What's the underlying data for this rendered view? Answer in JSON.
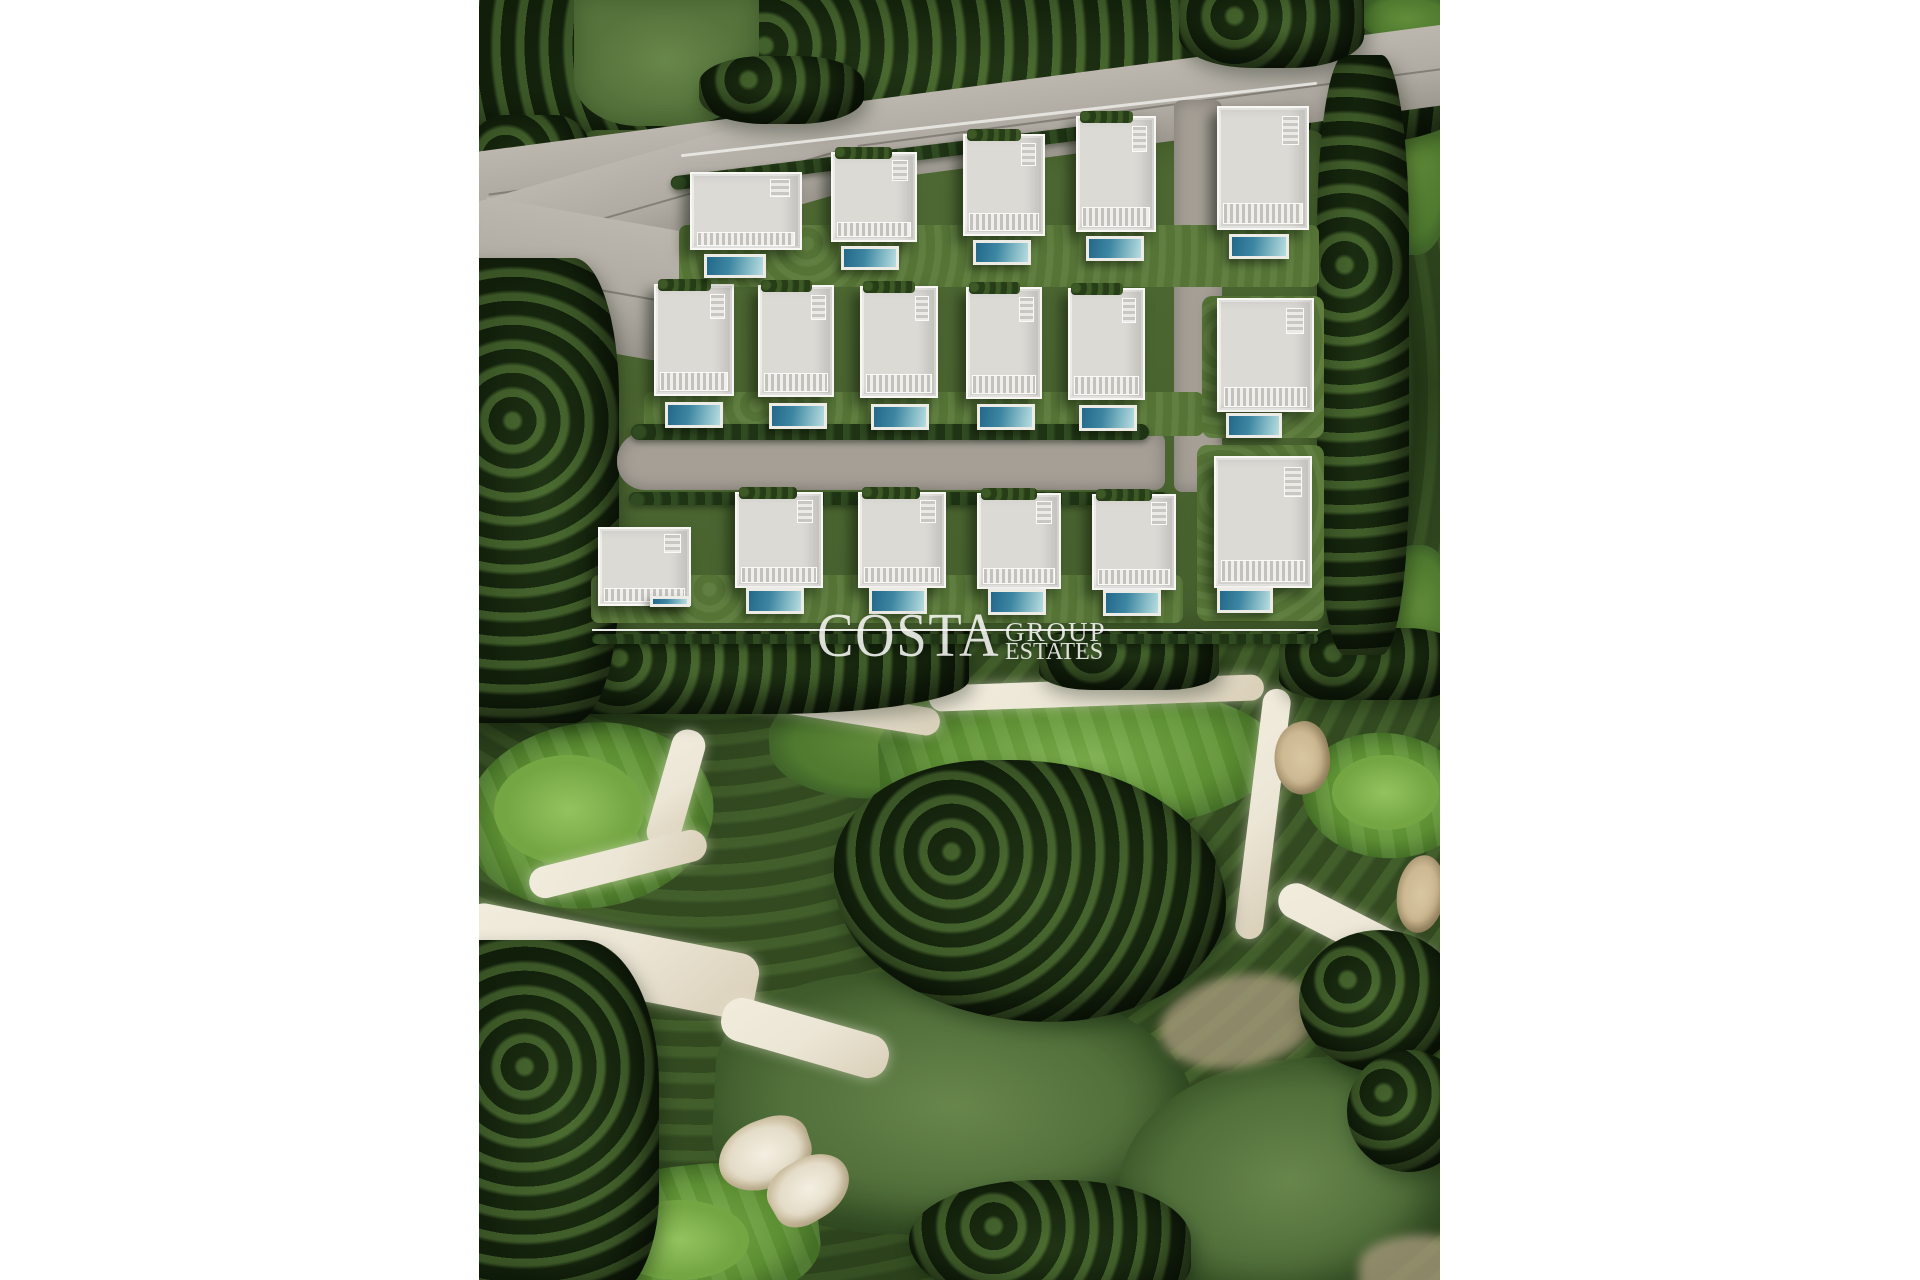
{
  "palette": {
    "canvas_bg": "#ffffff",
    "tree_dark": "#243b1a",
    "grass": "#5e7d40",
    "fairway_bright": "#6ba23f",
    "fairway_muted": "#55743d",
    "road": "#afaaa1",
    "road_inner": "#a59f96",
    "sand": "#ece6d6",
    "bunker": "#cdb992",
    "villa_roof": "#dcdad5",
    "villa_white": "#f8f7f4",
    "pool_deep": "#23688a",
    "pool_light": "#b8dde0",
    "lawn": "#5a7a39",
    "watermark": "rgba(253,253,250,0.85)"
  },
  "scene": {
    "x": 479,
    "y": 0,
    "width": 961,
    "height": 1280
  },
  "watermark": {
    "brand": "COSTA",
    "sub_top": "GROUP",
    "sub_bottom": "ESTATES",
    "line": {
      "x": 113,
      "y": 629,
      "width": 726,
      "height": 2
    },
    "brand_pos": {
      "x": 338,
      "y": 605,
      "size": 62,
      "ls": 2
    },
    "sub_top_pos": {
      "x": 526,
      "y": 619,
      "size": 27,
      "ls": 2
    },
    "sub_bottom_pos": {
      "x": 526,
      "y": 640,
      "size": 24,
      "ls": 0
    }
  },
  "elements": [
    {
      "name": "tree-band-top",
      "cls": "trees",
      "x": -10,
      "y": -12,
      "w": 985,
      "h": 165,
      "z": 6,
      "br": "0 0 22% 14%"
    },
    {
      "name": "grass-patch-top-left",
      "cls": "grass-light",
      "x": 95,
      "y": -6,
      "w": 185,
      "h": 132,
      "z": 7,
      "br": "0 0 45% 35%"
    },
    {
      "name": "grass-patch-top-right",
      "cls": "green-mid",
      "x": 878,
      "y": -6,
      "w": 100,
      "h": 50,
      "z": 7,
      "br": "0 0 0 60%"
    },
    {
      "name": "road-main",
      "cls": "road",
      "x": -15,
      "y": 88,
      "w": 1000,
      "h": 80,
      "rot": -7.5,
      "z": 8
    },
    {
      "name": "road-main-lower",
      "cls": "road",
      "x": -15,
      "y": 150,
      "w": 400,
      "h": 92,
      "rot": -16,
      "z": 8,
      "br": "0 0 40px 0"
    },
    {
      "name": "road-entry-apron",
      "cls": "road",
      "x": -5,
      "y": 215,
      "w": 218,
      "h": 132,
      "rot": 10,
      "z": 8,
      "br": "0 0 30px 70px"
    },
    {
      "name": "tree-overhang-left",
      "cls": "trees",
      "x": 220,
      "y": 56,
      "w": 165,
      "h": 68,
      "z": 9,
      "br": "40%"
    },
    {
      "name": "tree-overhang-right",
      "cls": "trees",
      "x": 700,
      "y": -12,
      "w": 185,
      "h": 80,
      "z": 9,
      "br": "0 0 40% 40%"
    },
    {
      "name": "development-ground",
      "cls": "dev",
      "x": 100,
      "y": 130,
      "w": 748,
      "h": 500,
      "z": 7,
      "br": "18px"
    },
    {
      "name": "retaining-wall-row1",
      "cls": "wall",
      "x": 200,
      "y": 118,
      "w": 640,
      "h": 3,
      "rot": -6.5,
      "z": 10
    },
    {
      "name": "hedge-row-along-road",
      "cls": "hedge",
      "x": 190,
      "y": 148,
      "w": 470,
      "h": 14,
      "rot": -7,
      "z": 10
    },
    {
      "name": "street-inner",
      "cls": "road2",
      "x": 138,
      "y": 432,
      "w": 548,
      "h": 58,
      "z": 9,
      "br": "28px 10px 10px 28px"
    },
    {
      "name": "lane-right-vertical",
      "cls": "road2",
      "x": 695,
      "y": 100,
      "w": 48,
      "h": 392,
      "z": 9,
      "br": "8px"
    },
    {
      "name": "hedge-row-above-street",
      "cls": "hedge",
      "x": 152,
      "y": 424,
      "w": 518,
      "h": 16,
      "z": 10
    },
    {
      "name": "hedge-row-below-street",
      "cls": "hedge",
      "x": 150,
      "y": 492,
      "w": 540,
      "h": 13,
      "z": 10
    },
    {
      "name": "lawn-row1",
      "cls": "lawn",
      "x": 200,
      "y": 225,
      "w": 640,
      "h": 62,
      "z": 9,
      "br": "8px"
    },
    {
      "name": "lawn-row2",
      "cls": "lawn",
      "x": 165,
      "y": 392,
      "w": 560,
      "h": 44,
      "z": 9,
      "br": "8px"
    },
    {
      "name": "lawn-villa-r2-6",
      "cls": "lawn",
      "x": 723,
      "y": 296,
      "w": 122,
      "h": 142,
      "z": 9,
      "br": "10px"
    },
    {
      "name": "lawn-row3",
      "cls": "lawn",
      "x": 112,
      "y": 575,
      "w": 592,
      "h": 48,
      "z": 9,
      "br": "8px"
    },
    {
      "name": "lawn-villa-r3-6",
      "cls": "lawn",
      "x": 718,
      "y": 445,
      "w": 127,
      "h": 176,
      "z": 9,
      "br": "10px"
    },
    {
      "name": "hedge-under-watermark",
      "cls": "hedge",
      "x": 113,
      "y": 634,
      "w": 726,
      "h": 10,
      "z": 19
    },
    {
      "name": "fairway-strip-right-top",
      "cls": "green-mid",
      "x": 893,
      "y": 55,
      "w": 82,
      "h": 200,
      "z": 1,
      "br": "45%"
    },
    {
      "name": "fairway-strip-right-mid",
      "cls": "green-mid",
      "x": 903,
      "y": 545,
      "w": 72,
      "h": 120,
      "z": 1,
      "br": "45%"
    },
    {
      "name": "golf-green-left",
      "cls": "green-bright",
      "x": -15,
      "y": 723,
      "w": 250,
      "h": 185,
      "z": 2,
      "rot": -8,
      "br": "50%"
    },
    {
      "name": "golf-green-left-apron",
      "cls": "green-lighter",
      "x": 15,
      "y": 755,
      "w": 150,
      "h": 110,
      "z": 3,
      "br": "50%"
    },
    {
      "name": "fairway-center-upper",
      "cls": "green-mid",
      "x": 290,
      "y": 678,
      "w": 250,
      "h": 120,
      "z": 2,
      "rot": -4,
      "br": "45% 55% 50% 50%"
    },
    {
      "name": "fairway-center-bright",
      "cls": "green-bright",
      "x": 400,
      "y": 685,
      "w": 400,
      "h": 150,
      "z": 2,
      "rot": -3,
      "br": "40% 60% 55% 45%"
    },
    {
      "name": "golf-green-right",
      "cls": "green-bright",
      "x": 823,
      "y": 733,
      "w": 167,
      "h": 125,
      "z": 2,
      "rot": 6,
      "br": "50%"
    },
    {
      "name": "golf-green-right-apron",
      "cls": "green-lighter",
      "x": 853,
      "y": 755,
      "w": 107,
      "h": 75,
      "z": 3,
      "br": "50%"
    },
    {
      "name": "fairway-bottom-center",
      "cls": "green-muted",
      "x": 235,
      "y": 975,
      "w": 480,
      "h": 262,
      "z": 1,
      "rot": 3,
      "br": "45% 55% 60% 40%"
    },
    {
      "name": "golf-green-bottom-left",
      "cls": "green-bright",
      "x": 90,
      "y": 1165,
      "w": 250,
      "h": 140,
      "z": 2,
      "rot": -6,
      "br": "50% 50% 40% 60%"
    },
    {
      "name": "golf-green-bottom-left-apron",
      "cls": "green-lighter",
      "x": 130,
      "y": 1200,
      "w": 140,
      "h": 80,
      "z": 3,
      "br": "50%"
    },
    {
      "name": "fairway-bottom-right",
      "cls": "green-muted",
      "x": 640,
      "y": 1060,
      "w": 340,
      "h": 242,
      "z": 1,
      "rot": -5,
      "br": "50% 40% 50% 50%"
    },
    {
      "name": "cart-path-top",
      "cls": "sand",
      "x": 450,
      "y": 680,
      "w": 335,
      "h": 26,
      "rot": -2,
      "z": 4,
      "br": "14px"
    },
    {
      "name": "cart-path-upper-left",
      "cls": "sand",
      "x": 262,
      "y": 694,
      "w": 200,
      "h": 28,
      "rot": 9,
      "z": 4,
      "br": "14px"
    },
    {
      "name": "cart-path-left-descent",
      "cls": "sand",
      "x": 180,
      "y": 728,
      "w": 34,
      "h": 122,
      "rot": 16,
      "z": 4,
      "br": "16px"
    },
    {
      "name": "cart-path-below-green",
      "cls": "sand",
      "x": 48,
      "y": 848,
      "w": 182,
      "h": 32,
      "rot": -14,
      "z": 4,
      "br": "16px"
    },
    {
      "name": "sand-wash-bottom-left",
      "cls": "sand",
      "x": -20,
      "y": 928,
      "w": 300,
      "h": 66,
      "rot": 11,
      "z": 4,
      "br": "20px"
    },
    {
      "name": "sand-wash-tail",
      "cls": "sand",
      "x": 240,
      "y": 1016,
      "w": 172,
      "h": 44,
      "rot": 16,
      "z": 4,
      "br": "20px"
    },
    {
      "name": "cart-path-right-vertical",
      "cls": "sand",
      "x": 770,
      "y": 688,
      "w": 28,
      "h": 252,
      "rot": 7,
      "z": 4,
      "br": "14px"
    },
    {
      "name": "cart-path-right-diagonal",
      "cls": "sand",
      "x": 788,
      "y": 930,
      "w": 242,
      "h": 36,
      "rot": 27,
      "z": 4,
      "br": "18px"
    },
    {
      "name": "sandy-rough-center-right",
      "cls": "sand-soft",
      "x": 680,
      "y": 975,
      "w": 160,
      "h": 92,
      "rot": -10,
      "z": 4,
      "br": "50%"
    },
    {
      "name": "sandy-escarpment-left",
      "cls": "sand-soft",
      "x": -20,
      "y": 390,
      "w": 62,
      "h": 260,
      "z": 4,
      "br": "40%"
    },
    {
      "name": "sandy-corner-bottom-right",
      "cls": "sand-soft",
      "x": 880,
      "y": 1235,
      "w": 122,
      "h": 60,
      "z": 4,
      "br": "50% 50% 0 0"
    },
    {
      "name": "bunker-right-upper",
      "cls": "bunker",
      "x": 795,
      "y": 722,
      "w": 56,
      "h": 72,
      "rot": -12,
      "z": 5,
      "br": "60% 40% 55% 45%"
    },
    {
      "name": "bunker-right-lower",
      "cls": "bunker",
      "x": 918,
      "y": 855,
      "w": 48,
      "h": 78,
      "rot": 8,
      "z": 5,
      "br": "50%"
    },
    {
      "name": "bunker-bottom-left-a",
      "cls": "bunker-light",
      "x": 238,
      "y": 1120,
      "w": 95,
      "h": 68,
      "rot": -18,
      "z": 5,
      "br": "60% 40% 50% 50%"
    },
    {
      "name": "bunker-bottom-left-b",
      "cls": "bunker-light",
      "x": 288,
      "y": 1158,
      "w": 85,
      "h": 62,
      "rot": -30,
      "z": 5,
      "br": "45% 55% 60% 40%"
    },
    {
      "name": "tree-column-left-upper",
      "cls": "trees",
      "x": -10,
      "y": 115,
      "w": 122,
      "h": 125,
      "z": 7,
      "br": "30%"
    },
    {
      "name": "tree-column-left",
      "cls": "trees",
      "x": -12,
      "y": 258,
      "w": 152,
      "h": 465,
      "z": 8,
      "br": "0 30% 30% 0"
    },
    {
      "name": "tree-column-right",
      "cls": "trees",
      "x": 838,
      "y": 55,
      "w": 92,
      "h": 600,
      "z": 8,
      "br": "30%"
    },
    {
      "name": "tree-band-mid-left",
      "cls": "trees",
      "x": -10,
      "y": 628,
      "w": 500,
      "h": 86,
      "z": 5,
      "br": "0 0 40% 20%"
    },
    {
      "name": "tree-patch-mid-center",
      "cls": "trees",
      "x": 560,
      "y": 628,
      "w": 180,
      "h": 62,
      "z": 5,
      "br": "30%"
    },
    {
      "name": "tree-patch-mid-right",
      "cls": "trees",
      "x": 800,
      "y": 628,
      "w": 180,
      "h": 72,
      "z": 5,
      "br": "30%"
    },
    {
      "name": "tree-cluster-center-golf",
      "cls": "trees",
      "x": 355,
      "y": 760,
      "w": 392,
      "h": 262,
      "z": 6,
      "br": "40% 55% 45% 55%"
    },
    {
      "name": "tree-cluster-bottom-left",
      "cls": "trees",
      "x": -12,
      "y": 940,
      "w": 192,
      "h": 362,
      "z": 6,
      "br": "0 40% 30% 0"
    },
    {
      "name": "tree-cluster-bottom-center",
      "cls": "trees",
      "x": 430,
      "y": 1180,
      "w": 282,
      "h": 132,
      "z": 6,
      "br": "50% 50% 40% 60%"
    },
    {
      "name": "tree-cluster-right-mid",
      "cls": "trees",
      "x": 820,
      "y": 930,
      "w": 162,
      "h": 142,
      "z": 6,
      "br": "50%"
    },
    {
      "name": "tree-cluster-right-low",
      "cls": "trees",
      "x": 868,
      "y": 1050,
      "w": 122,
      "h": 122,
      "z": 6,
      "br": "50%"
    }
  ],
  "villas": [
    {
      "name": "villa-r1-1",
      "b": [
        211,
        172,
        112,
        78
      ],
      "pool": [
        225,
        254,
        62,
        24
      ],
      "pergola": false
    },
    {
      "name": "villa-r1-2",
      "b": [
        352,
        152,
        86,
        90
      ],
      "pool": [
        362,
        246,
        58,
        24
      ],
      "pergola": true
    },
    {
      "name": "villa-r1-3",
      "b": [
        484,
        134,
        82,
        102
      ],
      "pool": [
        494,
        240,
        58,
        25
      ],
      "pergola": true
    },
    {
      "name": "villa-r1-4",
      "b": [
        597,
        116,
        80,
        116
      ],
      "pool": [
        607,
        236,
        58,
        25
      ],
      "pergola": true
    },
    {
      "name": "villa-r1-5",
      "b": [
        738,
        106,
        92,
        124
      ],
      "pool": [
        750,
        234,
        60,
        25
      ],
      "pergola": false
    },
    {
      "name": "villa-r2-1",
      "b": [
        175,
        284,
        80,
        112
      ],
      "pool": [
        186,
        402,
        58,
        26
      ],
      "pergola": true
    },
    {
      "name": "villa-r2-2",
      "b": [
        279,
        285,
        76,
        112
      ],
      "pool": [
        290,
        403,
        58,
        26
      ],
      "pergola": true
    },
    {
      "name": "villa-r2-3",
      "b": [
        381,
        286,
        78,
        112
      ],
      "pool": [
        392,
        404,
        58,
        26
      ],
      "pergola": true
    },
    {
      "name": "villa-r2-4",
      "b": [
        487,
        287,
        76,
        112
      ],
      "pool": [
        498,
        404,
        58,
        26
      ],
      "pergola": true
    },
    {
      "name": "villa-r2-5",
      "b": [
        589,
        288,
        77,
        112
      ],
      "pool": [
        600,
        405,
        58,
        26
      ],
      "pergola": true
    },
    {
      "name": "villa-r2-6",
      "b": [
        738,
        298,
        97,
        114
      ],
      "pool": [
        747,
        413,
        56,
        25
      ],
      "pergola": false
    },
    {
      "name": "villa-r3-1",
      "b": [
        119,
        527,
        93,
        79
      ],
      "pool": [
        171,
        596,
        40,
        11
      ],
      "pergola": false
    },
    {
      "name": "villa-r3-2",
      "b": [
        256,
        492,
        88,
        96
      ],
      "pool": [
        267,
        588,
        58,
        26
      ],
      "pergola": true
    },
    {
      "name": "villa-r3-3",
      "b": [
        379,
        492,
        88,
        96
      ],
      "pool": [
        390,
        588,
        58,
        26
      ],
      "pergola": true
    },
    {
      "name": "villa-r3-4",
      "b": [
        498,
        493,
        84,
        96
      ],
      "pool": [
        509,
        589,
        58,
        26
      ],
      "pergola": true
    },
    {
      "name": "villa-r3-5",
      "b": [
        613,
        494,
        84,
        96
      ],
      "pool": [
        624,
        590,
        58,
        26
      ],
      "pergola": true
    },
    {
      "name": "villa-r3-6",
      "b": [
        735,
        456,
        98,
        132
      ],
      "pool": [
        738,
        588,
        56,
        25
      ],
      "pergola": false
    }
  ]
}
